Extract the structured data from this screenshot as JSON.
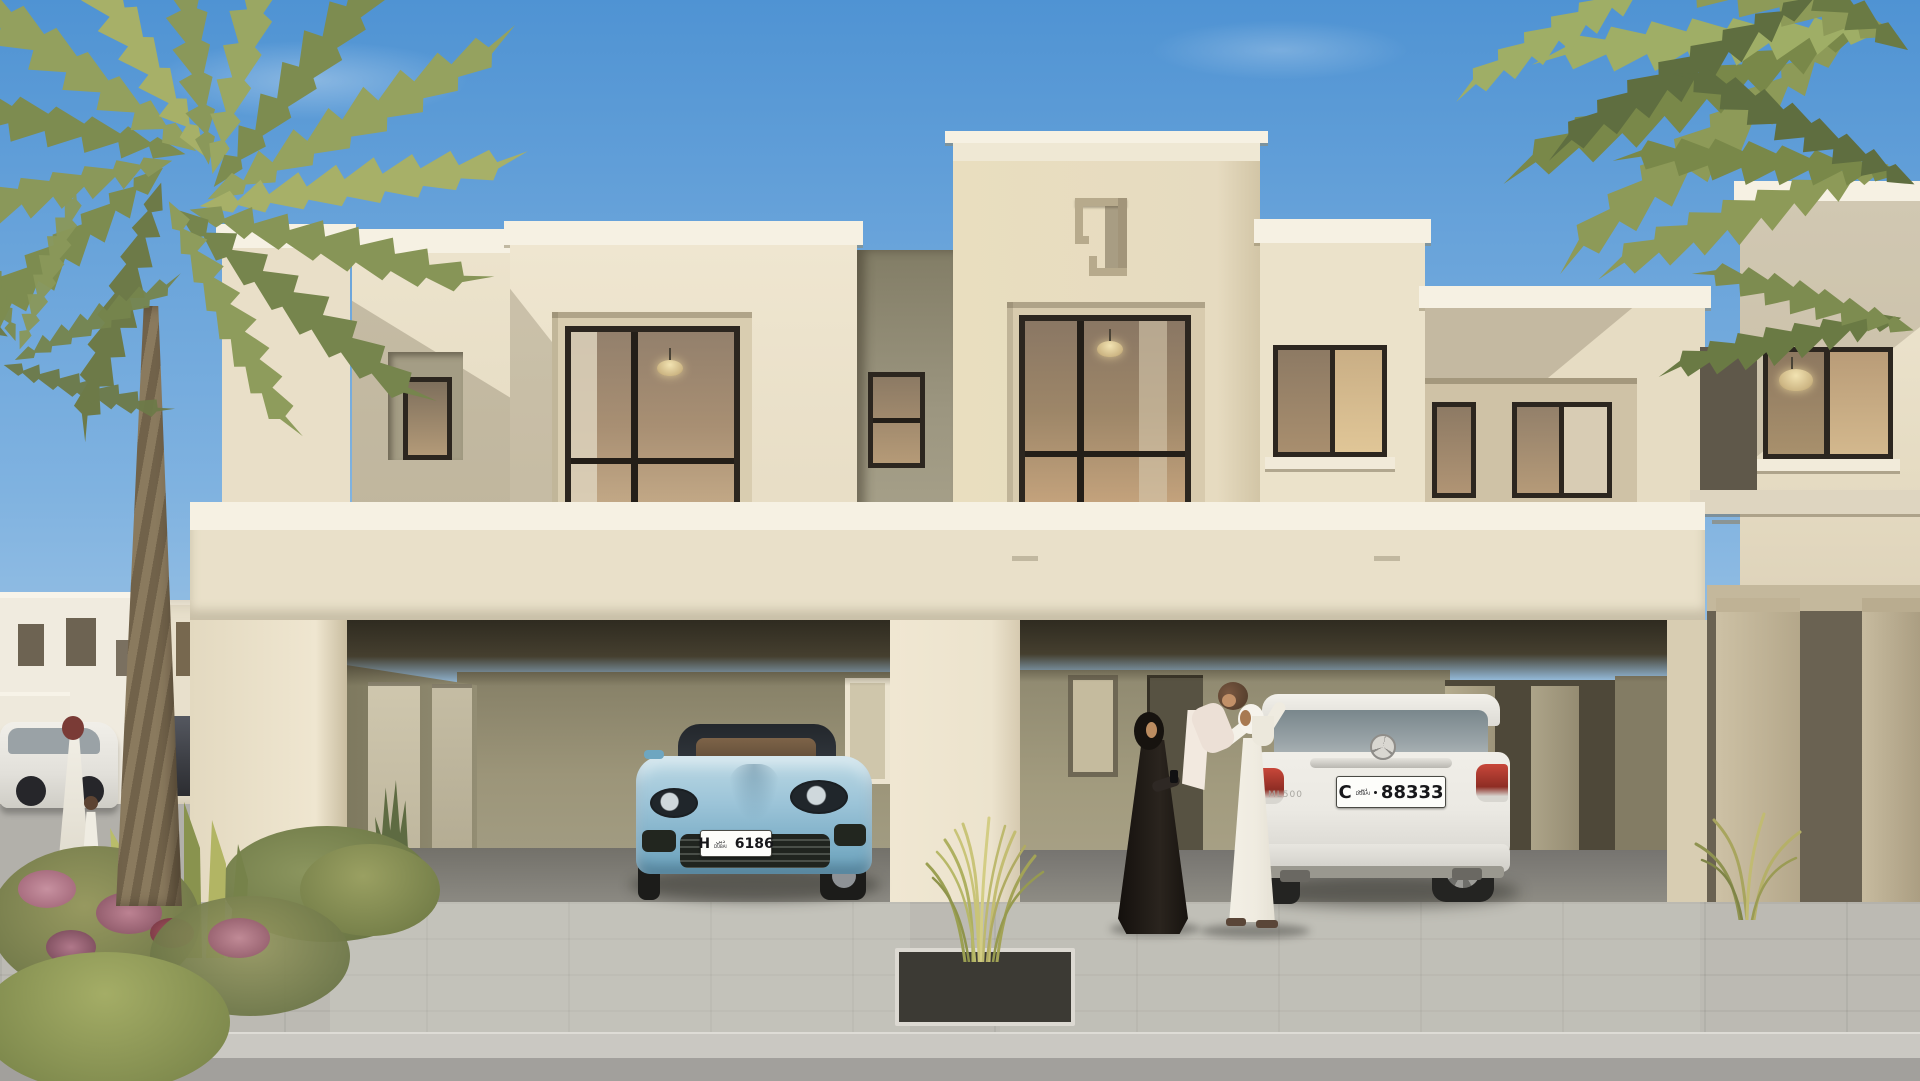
{
  "meta": {
    "type": "architectural exterior rendering",
    "description": "Sunny daytime rendering of a two-storey sand-coloured townhouse with two covered carport bays, date palms, an Emirati family and two parked cars",
    "sky": "clear blue"
  },
  "plates": {
    "sports_car": {
      "letter": "H",
      "region_ar": "دبي",
      "region_en": "DUBAI",
      "number": "6186"
    },
    "suv": {
      "letter": "C",
      "region_ar": "دبي",
      "region_en": "DUBAI",
      "number": "88333",
      "badge": "ML500"
    }
  },
  "scene": {
    "building": "cream stucco townhouse, flat parapet roofs, dark-framed windows, twin carport openings",
    "left_carport_vehicle": "light blue sports car",
    "right_carport_vehicle": "white SUV",
    "foreground_people": [
      "woman in black abaya looking at phone",
      "man in white kandura lifting a toddler",
      "toddler held aloft"
    ],
    "distant_people": [
      "adult in white thobe with small child near parked cars"
    ],
    "distant_vehicles": [
      "white crossover",
      "dark SUV"
    ],
    "vegetation": [
      "date palm left",
      "palm fronds top right",
      "flowering shrubs",
      "snake plants",
      "ornamental grasses in planter"
    ]
  },
  "palette": {
    "sky_top": "#5b9bd6",
    "sky_horizon": "#b9d3e8",
    "facade_light": "#ece3cd",
    "facade_shade": "#d8cdb2",
    "cap_white": "#f6f1e3",
    "recess_olive": "#978f74",
    "soffit_dark": "#3a3528",
    "window_frame": "#2c261f",
    "glass_warm": "#93806c",
    "porsche_blue": "#9cc4d8",
    "suv_white": "#ebe9e3",
    "paver_grey": "#bcbab3",
    "road_grey": "#a2a09c",
    "palm_green": "#8d9a58"
  }
}
